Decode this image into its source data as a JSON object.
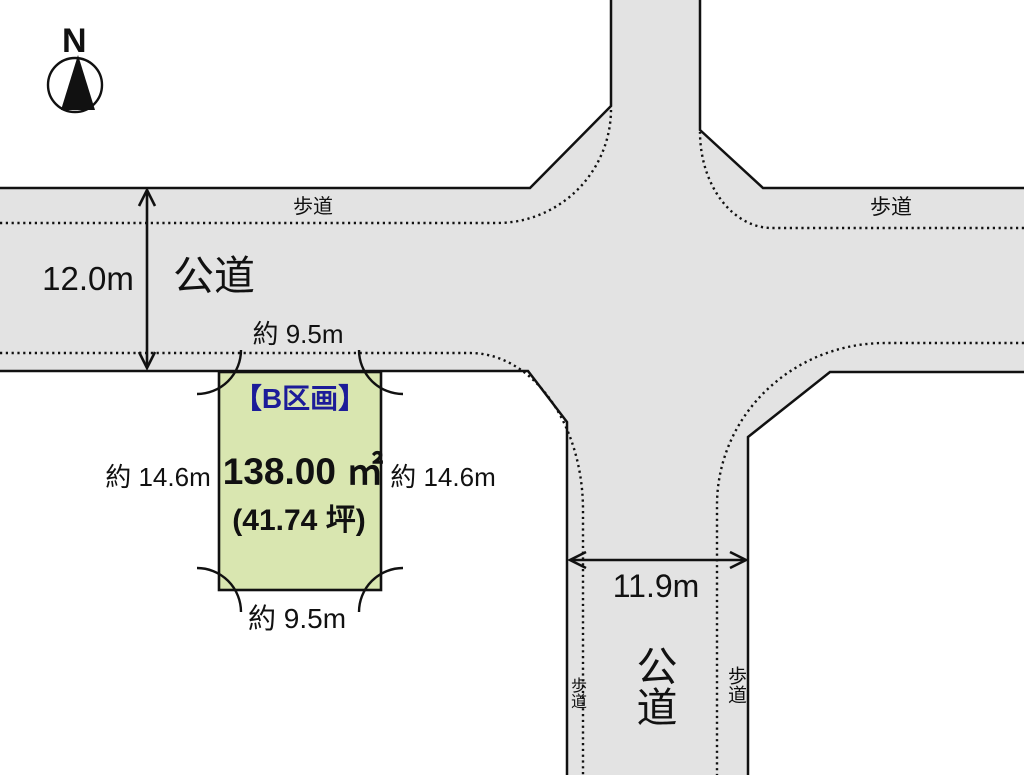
{
  "compass": {
    "north_label": "N"
  },
  "road_horizontal": {
    "name": "公道",
    "width": "12.0m",
    "sidewalk_label_left": "歩道",
    "sidewalk_label_right": "歩道"
  },
  "road_vertical": {
    "name": "公道",
    "width": "11.9m",
    "sidewalk_label_left": "歩道",
    "sidewalk_label_right": "歩道"
  },
  "plot": {
    "title": "【B区画】",
    "area_sqm": "138.00 ㎡",
    "area_tsubo": "(41.74 坪)",
    "width_top": "約 9.5m",
    "width_bottom": "約 9.5m",
    "depth_left": "約 14.6m",
    "depth_right": "約 14.6m"
  },
  "colors": {
    "road_fill": "#e3e3e3",
    "plot_fill": "#d9e6b0",
    "line": "#111111",
    "plot_title_color": "#1c1c99"
  }
}
